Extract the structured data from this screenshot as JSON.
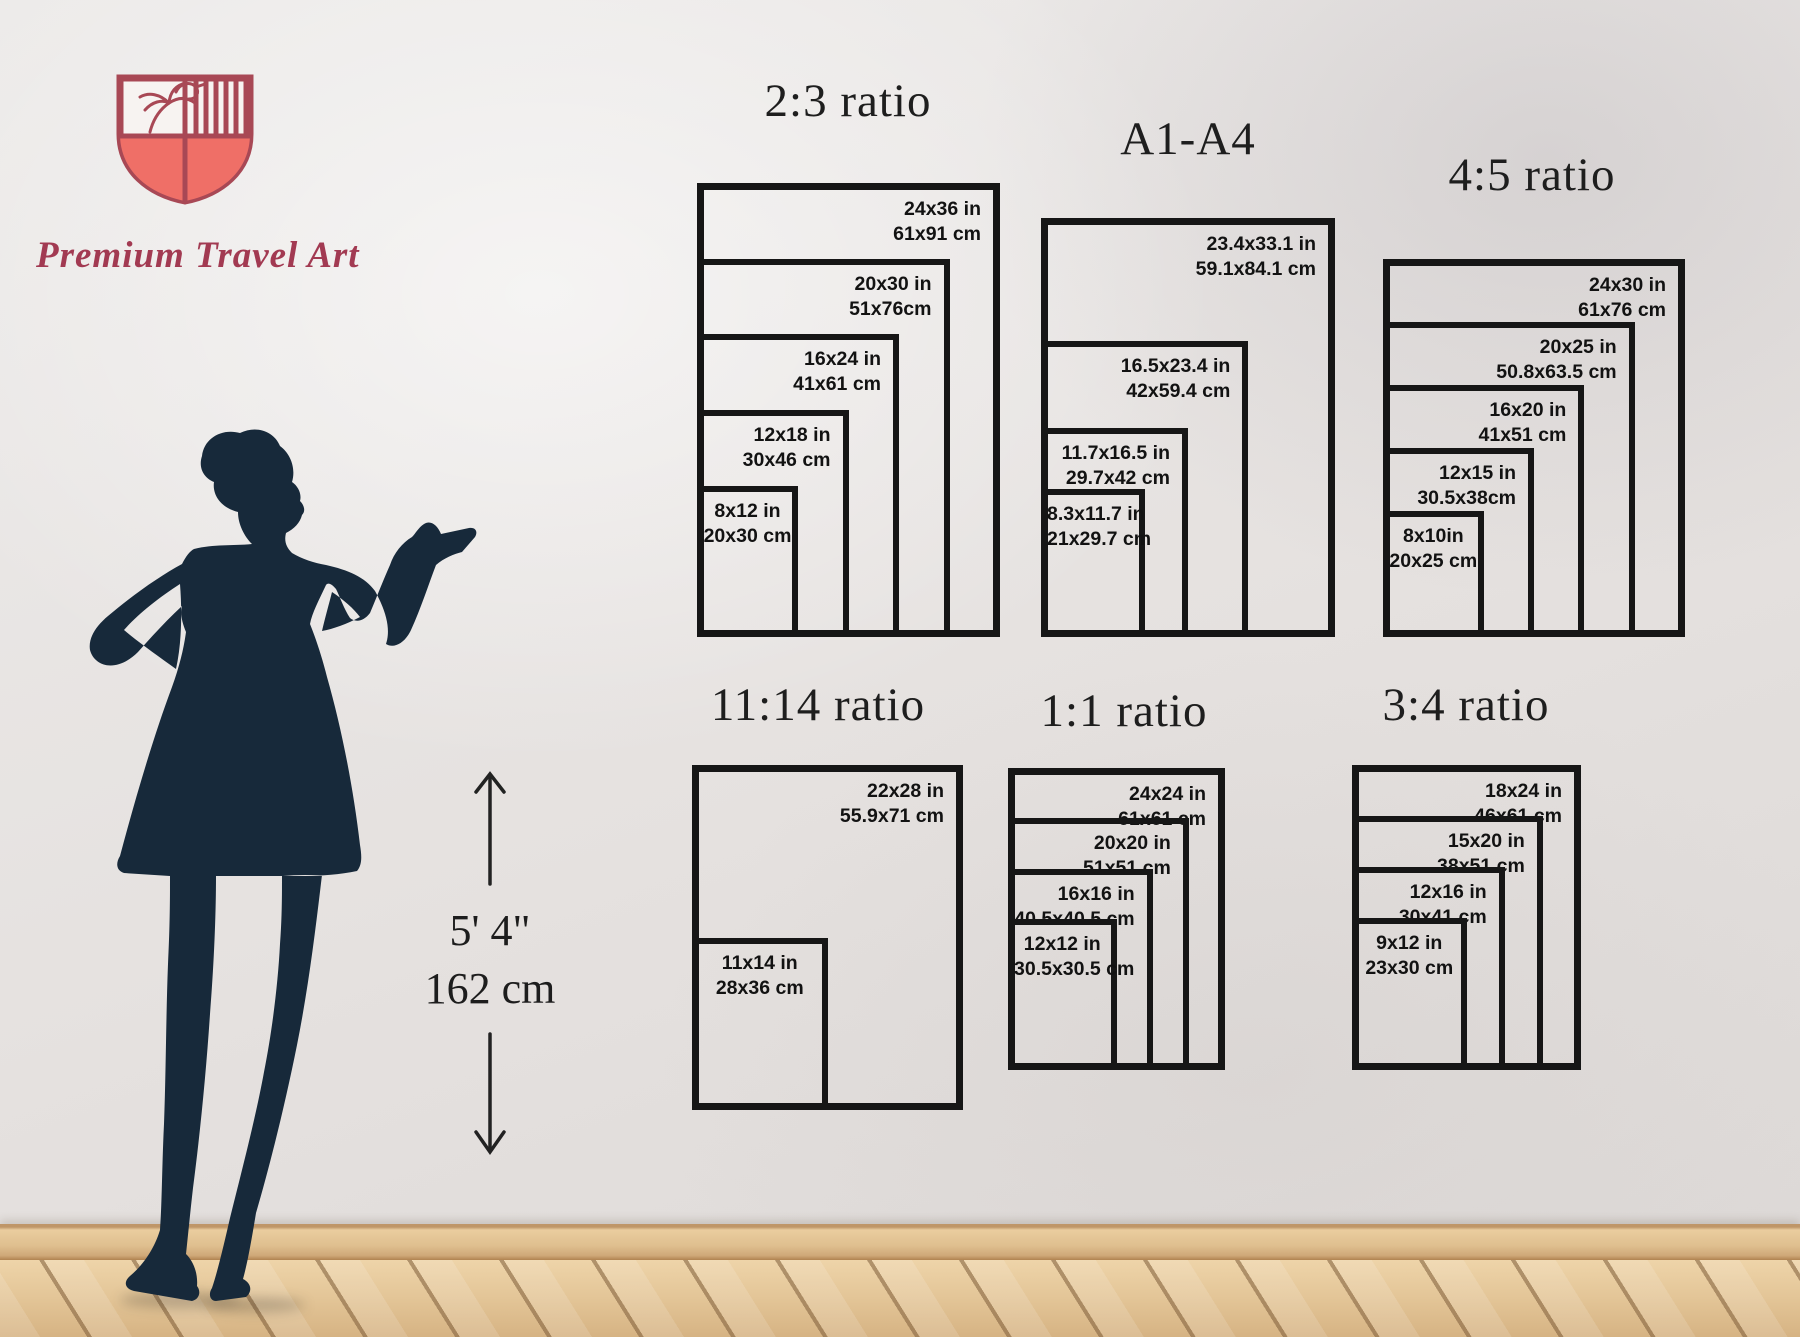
{
  "brand": {
    "name": "Premium Travel Art",
    "logo_icon": "shield-palm-crest",
    "colors": {
      "outline": "#a84855",
      "fill": "#ef6f67",
      "text": "#a23a52"
    }
  },
  "person": {
    "silhouette": "woman-presenting",
    "height_ft": "5' 4\"",
    "height_cm": "162 cm",
    "silhouette_color": "#17293a"
  },
  "colors": {
    "frame": "#161616",
    "label": "#121212",
    "title": "#1e1e1e"
  },
  "charts": [
    {
      "id": "r23",
      "title": "2:3 ratio",
      "sizes": [
        {
          "w": 24,
          "h": 36,
          "in": "24x36 in",
          "cm": "61x91 cm",
          "align": "right"
        },
        {
          "w": 20,
          "h": 30,
          "in": "20x30 in",
          "cm": "51x76cm",
          "align": "right"
        },
        {
          "w": 16,
          "h": 24,
          "in": "16x24 in",
          "cm": "41x61 cm",
          "align": "right"
        },
        {
          "w": 12,
          "h": 18,
          "in": "12x18 in",
          "cm": "30x46 cm",
          "align": "right"
        },
        {
          "w": 8,
          "h": 12,
          "in": "8x12 in",
          "cm": "20x30 cm",
          "align": "center"
        }
      ]
    },
    {
      "id": "a14",
      "title": "A1-A4",
      "sizes": [
        {
          "w": 23.4,
          "h": 33.1,
          "in": "23.4x33.1 in",
          "cm": "59.1x84.1 cm",
          "align": "right"
        },
        {
          "w": 16.5,
          "h": 23.4,
          "in": "16.5x23.4 in",
          "cm": "42x59.4 cm",
          "align": "right"
        },
        {
          "w": 11.7,
          "h": 16.5,
          "in": "11.7x16.5 in",
          "cm": "29.7x42 cm",
          "align": "right"
        },
        {
          "w": 8.3,
          "h": 11.7,
          "in": "8.3x11.7 in",
          "cm": "21x29.7 cm",
          "align": "center"
        }
      ]
    },
    {
      "id": "r45",
      "title": "4:5 ratio",
      "sizes": [
        {
          "w": 24,
          "h": 30,
          "in": "24x30 in",
          "cm": "61x76 cm",
          "align": "right"
        },
        {
          "w": 20,
          "h": 25,
          "in": "20x25 in",
          "cm": "50.8x63.5 cm",
          "align": "right"
        },
        {
          "w": 16,
          "h": 20,
          "in": "16x20 in",
          "cm": "41x51 cm",
          "align": "right"
        },
        {
          "w": 12,
          "h": 15,
          "in": "12x15 in",
          "cm": "30.5x38cm",
          "align": "right"
        },
        {
          "w": 8,
          "h": 10,
          "in": "8x10in",
          "cm": "20x25 cm",
          "align": "center"
        }
      ]
    },
    {
      "id": "r1114",
      "title": "11:14 ratio",
      "sizes": [
        {
          "w": 22,
          "h": 28,
          "in": "22x28 in",
          "cm": "55.9x71 cm",
          "align": "right"
        },
        {
          "w": 11,
          "h": 14,
          "in": "11x14 in",
          "cm": "28x36 cm",
          "align": "center"
        }
      ]
    },
    {
      "id": "r11",
      "title": "1:1 ratio",
      "sizes": [
        {
          "w": 24,
          "h": 24,
          "in": "24x24 in",
          "cm": "61x61 cm",
          "align": "right"
        },
        {
          "w": 20,
          "h": 20,
          "in": "20x20 in",
          "cm": "51x51 cm",
          "align": "right"
        },
        {
          "w": 16,
          "h": 16,
          "in": "16x16 in",
          "cm": "40.5x40.5 cm",
          "align": "right"
        },
        {
          "w": 12,
          "h": 12,
          "in": "12x12 in",
          "cm": "30.5x30.5 cm",
          "align": "center"
        }
      ]
    },
    {
      "id": "r34",
      "title": "3:4 ratio",
      "sizes": [
        {
          "w": 18,
          "h": 24,
          "in": "18x24 in",
          "cm": "46x61 cm",
          "align": "right"
        },
        {
          "w": 15,
          "h": 20,
          "in": "15x20 in",
          "cm": "38x51 cm",
          "align": "right"
        },
        {
          "w": 12,
          "h": 16,
          "in": "12x16 in",
          "cm": "30x41 cm",
          "align": "right"
        },
        {
          "w": 9,
          "h": 12,
          "in": "9x12 in",
          "cm": "23x30 cm",
          "align": "center"
        }
      ]
    }
  ]
}
